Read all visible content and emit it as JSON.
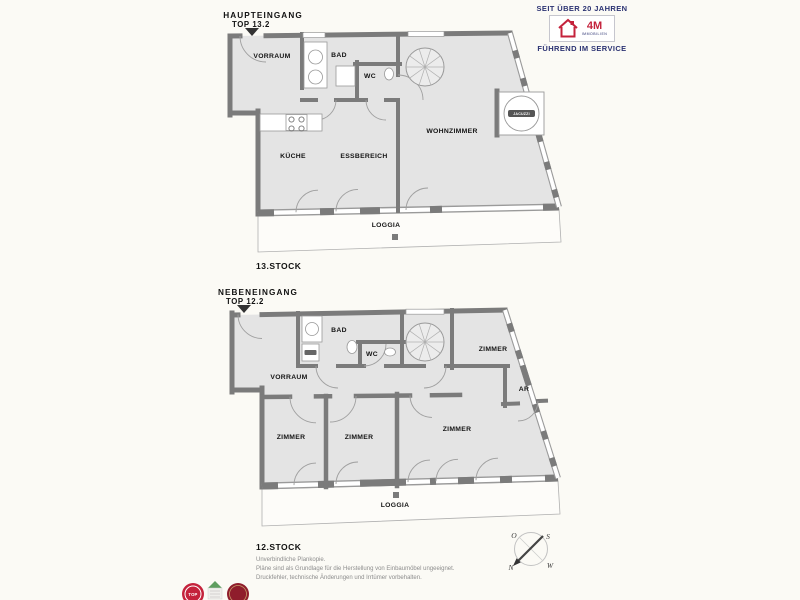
{
  "branding": {
    "seit_line": "SEIT ÜBER 20 JAHREN",
    "logo_text": "4M",
    "logo_subtext": "IMMOBILIEN",
    "service_line": "FÜHREND IM SERVICE"
  },
  "upper_plan": {
    "entrance": {
      "line1": "HAUPTEINGANG",
      "line2": "TOP 13.2"
    },
    "floor_label": "13.STOCK",
    "rooms": {
      "vorraum": "VORRAUM",
      "bad": "BAD",
      "wc": "WC",
      "kueche": "KÜCHE",
      "essbereich": "ESSBEREICH",
      "wohnzimmer": "WOHNZIMMER",
      "loggia": "LOGGIA"
    },
    "jacuzzi": "JACUZZI"
  },
  "lower_plan": {
    "entrance": {
      "line1": "NEBENEINGANG",
      "line2": "TOP 12.2"
    },
    "floor_label": "12.STOCK",
    "rooms": {
      "vorraum": "VORRAUM",
      "bad": "BAD",
      "wc": "WC",
      "zimmer_top": "ZIMMER",
      "ar": "AR",
      "zimmer_left": "ZIMMER",
      "zimmer_mid": "ZIMMER",
      "zimmer_right": "ZIMMER",
      "loggia": "LOGGIA"
    }
  },
  "disclaimer": {
    "line1": "Unverbindliche Plankopie.",
    "line2": "Pläne sind als Grundlage für die Herstellung von Einbaumöbel ungeeignet.",
    "line3": "Druckfehler, technische Änderungen und Irrtümer vorbehalten."
  },
  "compass": {
    "north": "N",
    "east": "O",
    "south": "S",
    "west": "W"
  },
  "badges": {
    "badge1": "TOP"
  },
  "colors": {
    "wall": "#7b7b7b",
    "room_fill": "#e4e4e4",
    "background": "#fbfaf5",
    "accent_red": "#c4223b",
    "accent_navy": "#2b3272"
  }
}
